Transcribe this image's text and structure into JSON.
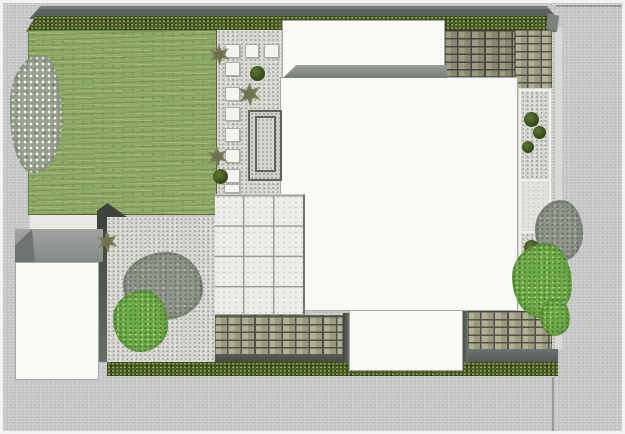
{
  "meta": {
    "description": "top-down-garden-landscape-plan-render",
    "canvas": {
      "width": 625,
      "height": 434
    }
  },
  "palette": {
    "frame": "#f3f4f1",
    "road": "#c5c7c6",
    "curb": "#d8d9d5",
    "line": "#9a9c9b",
    "wall": "#5d615e",
    "wall_light": "#787c79",
    "hedge": "#4a5a27",
    "hedge_light": "#93a855",
    "hedge_dark": "#24300f",
    "hedge_cap": "#7e827f",
    "lawn": "#8fab6a",
    "gravel": "#d6d7d1",
    "gravel_dark": "#9e9f95",
    "gravel_mid": "#bfc0b8",
    "stone": "#f3f3ef",
    "stone_border": "#a9aaa0",
    "planter_border": "#5f645a",
    "planter_fill": "#cfd0c9",
    "patio": "#edeee9",
    "patio_line": "#99a099",
    "patio_edge": "#6d736d",
    "house": "#fbfbf8",
    "house_outline": "#a8a9a5",
    "band_top": "#9aa099",
    "band_bottom": "#767b75",
    "brick_mortar": "#50534a",
    "brick_face": "#b2b094",
    "brick_face2": "#9b997e",
    "dark_band": "#6e7370",
    "shadow": "#3f433e",
    "gap_light": "#e8e9e5",
    "pale_bed": "#e2e3dd",
    "shed_roof_dark": "#6f7371",
    "bush_hi": "#5f7637",
    "bush_lo": "#324416",
    "shrub_olive": "#8c8d6c",
    "shrub_olive_dark": "#6e7050",
    "blossom_base": "#9aa08e",
    "blossom_dot": "#f7f7f2",
    "gray_foliage": "#8f958a",
    "gray_foliage_dark": "#6d736a",
    "gray_foliage_light": "#b3b8ae",
    "green_foliage": "#6faa48",
    "green_foliage_dark": "#4b8430",
    "green_foliage_light": "#aad47f"
  },
  "elements": [
    {
      "n": "street-pavement",
      "c": "road",
      "r": [
        3,
        3,
        619,
        428
      ]
    },
    {
      "n": "curb-strip-right",
      "c": "curb",
      "r": [
        555,
        27,
        7,
        323
      ]
    },
    {
      "n": "street-line-top-right",
      "c": "hline",
      "r": [
        556,
        5,
        66,
        2
      ]
    },
    {
      "n": "street-line-bottom-right",
      "c": "vline",
      "r": [
        552,
        377,
        2,
        54
      ]
    },
    {
      "n": "boundary-wall-top",
      "c": "wall",
      "r": [
        29,
        6,
        529,
        13
      ]
    },
    {
      "n": "hedge-top",
      "c": "hedge slant",
      "r": [
        26,
        16,
        530,
        16
      ]
    },
    {
      "n": "hedge-top-end-cap",
      "c": "cap",
      "r": [
        546,
        13,
        13,
        19
      ]
    },
    {
      "n": "lawn",
      "c": "lawn",
      "r": [
        28,
        30,
        189,
        185
      ]
    },
    {
      "n": "gravel-path-top",
      "c": "gravel",
      "r": [
        217,
        30,
        65,
        165
      ]
    },
    {
      "n": "gravel-court-bottom-left",
      "c": "gravel",
      "r": [
        107,
        217,
        108,
        145
      ]
    },
    {
      "n": "court-shadow-strip",
      "c": "vshadow",
      "r": [
        97,
        215,
        10,
        147
      ]
    },
    {
      "n": "level-change-wedge",
      "c": "wedge",
      "r": [
        97,
        203,
        30,
        14
      ]
    },
    {
      "n": "shed-path-gap",
      "c": "gap",
      "r": [
        30,
        215,
        67,
        15
      ]
    },
    {
      "n": "shed-roof",
      "c": "shedroof",
      "r": [
        15,
        229,
        88,
        33
      ]
    },
    {
      "n": "shed-roof-slope",
      "c": "shedslope",
      "r": [
        15,
        229,
        20,
        33
      ]
    },
    {
      "n": "shed",
      "c": "white-building",
      "r": [
        15,
        262,
        84,
        118
      ]
    },
    {
      "n": "brick-paving-top",
      "c": "bricks tone-dark",
      "r": [
        445,
        30,
        70,
        47
      ]
    },
    {
      "n": "brick-paving-top-right",
      "c": "bricks",
      "r": [
        515,
        30,
        37,
        60
      ]
    },
    {
      "n": "brick-paving-bottom-left",
      "c": "bricks",
      "r": [
        215,
        315,
        128,
        40
      ]
    },
    {
      "n": "brick-underline-left",
      "c": "underline",
      "r": [
        215,
        354,
        135,
        8
      ]
    },
    {
      "n": "brick-paving-bottom-right",
      "c": "bricks",
      "r": [
        468,
        311,
        84,
        39
      ]
    },
    {
      "n": "retaining-band-right",
      "c": "darkband",
      "r": [
        468,
        349,
        90,
        13
      ]
    },
    {
      "n": "hedge-bottom",
      "c": "hedge",
      "r": [
        107,
        362,
        451,
        14
      ]
    },
    {
      "n": "house-rear-wing",
      "c": "white-building",
      "r": [
        282,
        20,
        163,
        58
      ]
    },
    {
      "n": "house-main",
      "c": "white-building",
      "r": [
        280,
        77,
        238,
        234
      ]
    },
    {
      "n": "flat-roof-band",
      "c": "roofband",
      "r": [
        283,
        65,
        164,
        13
      ]
    },
    {
      "n": "side-bed-border",
      "c": "bed-border",
      "r": [
        518,
        88,
        34,
        223
      ]
    },
    {
      "n": "side-bed-gravel-upper",
      "c": "gravel",
      "r": [
        521,
        91,
        28,
        88
      ]
    },
    {
      "n": "side-bed-pale-section",
      "c": "pale",
      "r": [
        521,
        181,
        28,
        50
      ]
    },
    {
      "n": "side-bed-gravel-lower",
      "c": "gravel",
      "r": [
        521,
        233,
        28,
        76
      ]
    },
    {
      "n": "patio-grid",
      "c": "patio",
      "r": [
        215,
        194,
        90,
        121
      ]
    },
    {
      "n": "planter-feature",
      "c": "planter",
      "r": [
        248,
        110,
        34,
        71
      ]
    },
    {
      "n": "planter-feature-inner",
      "c": "planter-inner",
      "r": [
        255,
        116,
        21,
        56
      ]
    },
    {
      "n": "stepping-stone",
      "c": "stone",
      "r": [
        225,
        44,
        15,
        14
      ]
    },
    {
      "n": "stepping-stone",
      "c": "stone",
      "r": [
        245,
        44,
        14,
        14
      ]
    },
    {
      "n": "stepping-stone",
      "c": "stone",
      "r": [
        264,
        44,
        15,
        14
      ]
    },
    {
      "n": "stepping-stone",
      "c": "stone",
      "r": [
        225,
        62,
        15,
        14
      ]
    },
    {
      "n": "stepping-stone",
      "c": "stone",
      "r": [
        225,
        87,
        15,
        14
      ]
    },
    {
      "n": "stepping-stone",
      "c": "stone",
      "r": [
        225,
        107,
        15,
        14
      ]
    },
    {
      "n": "stepping-stone",
      "c": "stone",
      "r": [
        225,
        128,
        15,
        14
      ]
    },
    {
      "n": "stepping-stone",
      "c": "stone",
      "r": [
        225,
        149,
        15,
        14
      ]
    },
    {
      "n": "stepping-stone",
      "c": "stone",
      "r": [
        225,
        169,
        15,
        14
      ]
    },
    {
      "n": "stepping-stone",
      "c": "stone",
      "r": [
        224,
        184,
        16,
        9
      ]
    },
    {
      "n": "shrub-olive",
      "c": "shrub",
      "r": [
        208,
        44,
        22,
        22
      ]
    },
    {
      "n": "shrub-olive",
      "c": "shrub",
      "r": [
        238,
        82,
        23,
        25
      ]
    },
    {
      "n": "shrub-olive",
      "c": "shrub",
      "r": [
        206,
        146,
        22,
        22
      ]
    },
    {
      "n": "shrub-olive",
      "c": "shrub",
      "r": [
        96,
        231,
        22,
        22
      ]
    },
    {
      "n": "bush-round",
      "c": "bush",
      "r": [
        250,
        66,
        15,
        15
      ]
    },
    {
      "n": "bush-round",
      "c": "bush",
      "r": [
        213,
        169,
        15,
        15
      ]
    },
    {
      "n": "bush-round",
      "c": "bush",
      "r": [
        524,
        112,
        15,
        15
      ]
    },
    {
      "n": "bush-round",
      "c": "bush",
      "r": [
        533,
        126,
        13,
        13
      ]
    },
    {
      "n": "bush-round",
      "c": "bush",
      "r": [
        522,
        141,
        12,
        12
      ]
    },
    {
      "n": "bush-round",
      "c": "bush",
      "r": [
        524,
        240,
        15,
        15
      ]
    },
    {
      "n": "bush-round",
      "c": "bush",
      "r": [
        534,
        253,
        16,
        16
      ]
    },
    {
      "n": "bush-round",
      "c": "bush",
      "r": [
        519,
        266,
        12,
        12
      ]
    },
    {
      "n": "garage-shadow-left",
      "c": "vshadow2",
      "r": [
        343,
        313,
        7,
        50
      ]
    },
    {
      "n": "garage-shadow-right",
      "c": "vshadow2",
      "r": [
        462,
        311,
        6,
        52
      ]
    },
    {
      "n": "garage",
      "c": "white-building",
      "r": [
        349,
        310,
        114,
        61
      ]
    },
    {
      "n": "blossom-tree",
      "c": "blossom",
      "r": [
        10,
        55,
        52,
        118
      ]
    },
    {
      "n": "tree-gray-court",
      "c": "grayblob",
      "r": [
        123,
        252,
        80,
        68
      ]
    },
    {
      "n": "shrub-green-court",
      "c": "greenblob",
      "r": [
        113,
        290,
        55,
        62
      ]
    },
    {
      "n": "tree-gray-right",
      "c": "grayblob",
      "r": [
        535,
        200,
        48,
        62
      ]
    },
    {
      "n": "tree-green-right",
      "c": "greenblob",
      "r": [
        512,
        243,
        60,
        75
      ]
    },
    {
      "n": "tree-green-right-lower",
      "c": "greenblob",
      "r": [
        540,
        298,
        30,
        38
      ]
    }
  ]
}
